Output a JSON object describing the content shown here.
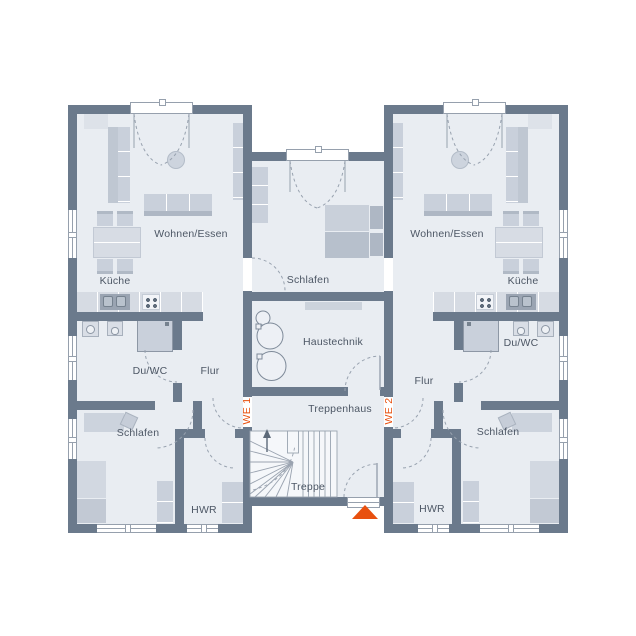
{
  "plan": {
    "we1": {
      "label": "WE 1",
      "living": "Wohnen/Essen",
      "kitchen": "Küche",
      "bath": "Du/WC",
      "hall": "Flur",
      "bedroom": "Schlafen",
      "utility": "HWR"
    },
    "we2": {
      "label": "WE 2",
      "living": "Wohnen/Essen",
      "kitchen": "Küche",
      "bath": "Du/WC",
      "hall": "Flur",
      "bedroom": "Schlafen",
      "utility": "HWR"
    },
    "core": {
      "bedroom": "Schlafen",
      "tech": "Haustechnik",
      "stairhall": "Treppenhaus",
      "stairs": "Treppe"
    }
  },
  "colors": {
    "wall": "#6b7a8c",
    "floor": "#e9edf2",
    "accent": "#e8500f",
    "line": "#96a0ad",
    "text": "#4d5765",
    "f1": "#d6dbe3",
    "f2": "#c9d0db",
    "f3": "#aeb7c4",
    "stairbg": "#f5f7fa"
  }
}
